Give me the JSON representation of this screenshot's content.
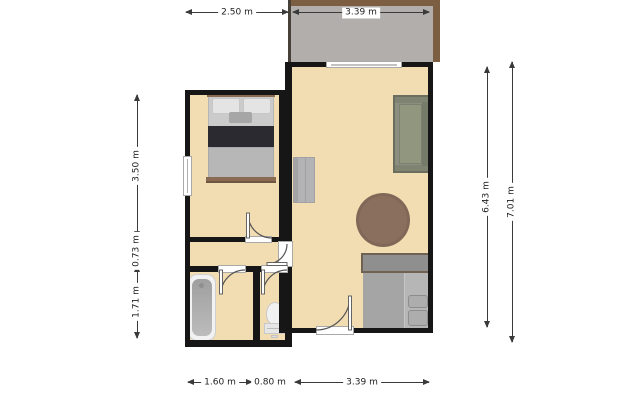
{
  "dims": {
    "top_1": "2.50 m",
    "top_2": "3.39 m",
    "bottom_1": "1.60 m",
    "bottom_2": "0.80 m",
    "bottom_3": "3.39 m",
    "left_1": "3.50 m",
    "left_2": "0.73 m",
    "left_3": "1.71 m",
    "right_1": "6.43 m",
    "right_2": "7.01 m"
  },
  "colors": {
    "floor": "#f2ddb3",
    "wall": "#161616",
    "balcony_floor": "#b1aeab",
    "balcony_rail": "#7c5f42",
    "sofa": "#8b907e",
    "round_table": "#8b6f5e",
    "bed_blanket": "#2a2a30",
    "bed_frame": "#8a6b51",
    "kitchen_counter": "#a5a5a5",
    "dimension_line": "#3a3a3a"
  },
  "plan": {
    "rooms": [
      {
        "name": "balcony",
        "furniture": []
      },
      {
        "name": "living-room",
        "furniture": [
          "sofa",
          "round-table",
          "kitchen-counter",
          "wall-shelf"
        ]
      },
      {
        "name": "bedroom",
        "furniture": [
          "double-bed"
        ]
      },
      {
        "name": "hallway",
        "furniture": []
      },
      {
        "name": "bathroom",
        "furniture": [
          "bathtub"
        ]
      },
      {
        "name": "wc",
        "furniture": [
          "toilet"
        ]
      }
    ],
    "door_count": 5,
    "window_count": 2
  }
}
